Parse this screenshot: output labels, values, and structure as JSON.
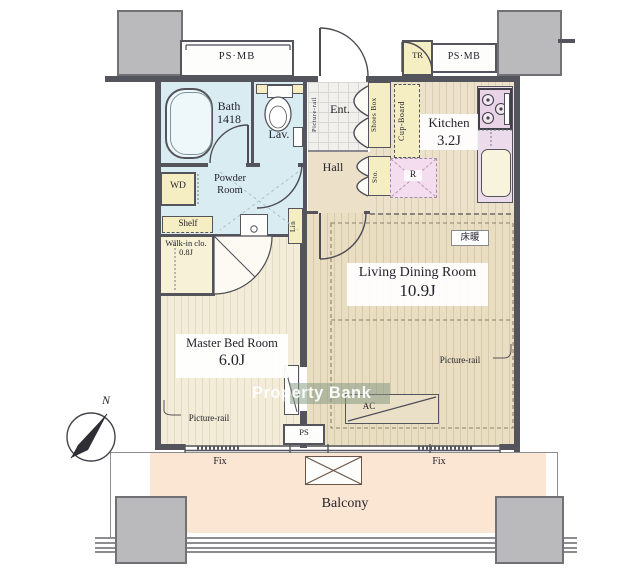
{
  "title": "Japanese apartment floor plan (1LDK) with balcony",
  "colors": {
    "wall": "#54545c",
    "pillar": "#bababd",
    "wet_area": "#d9ecf2",
    "closet_yellow": "#f5eec2",
    "kitchen_counter_pink": "#ecdceb",
    "fridge_pink": "#f3ddee",
    "living_floor": "#e9ddc2",
    "bedroom_floor": "#f2ecd9",
    "balcony": "#fbe5d3",
    "watermark_text": "#ffffff"
  },
  "labels": {
    "ps_mb_left": "PS·MB",
    "ps_mb_right": "PS·MB",
    "tr": "TR",
    "bath": "Bath",
    "bath_size": "1418",
    "lav": "Lav.",
    "ent": "Ent.",
    "picture_rail_ent": "Picture-rail",
    "shoes_box": "Shoes Box",
    "cup_board": "Cup-Board",
    "kitchen": "Kitchen",
    "kitchen_size": "3.2J",
    "refrigerator": "R",
    "sto": "Sto.",
    "hall": "Hall",
    "wd": "WD",
    "powder_line1": "Powder",
    "powder_line2": "Room",
    "shelf": "Shelf",
    "walk_in": "Walk-in clo.",
    "walk_in_size": "0.8J",
    "lin": "Lin",
    "floor_heating": "床暖",
    "living": "Living Dining Room",
    "living_size": "10.9J",
    "picture_rail_living": "Picture-rail",
    "master": "Master Bed Room",
    "master_size": "6.0J",
    "picture_rail_master": "Picture-rail",
    "ac": "AC",
    "ps_bottom": "PS",
    "fix_left": "Fix",
    "fix_right": "Fix",
    "balcony": "Balcony",
    "compass_north": "N",
    "watermark": "Property Bank"
  }
}
